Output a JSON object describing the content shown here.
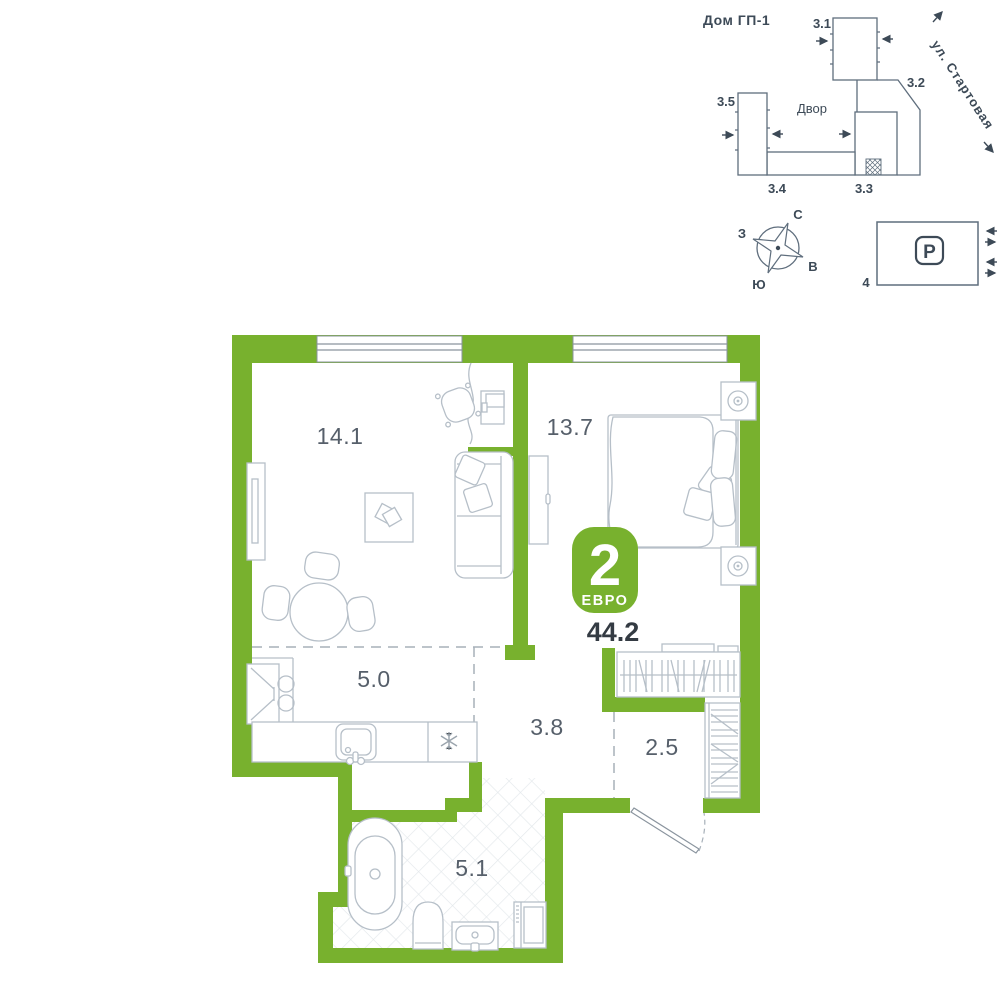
{
  "floor_plan": {
    "badge": {
      "rooms_number": "2",
      "type": "ЕВРО"
    },
    "total_area": "44.2",
    "areas": {
      "living_room": "14.1",
      "bedroom": "13.7",
      "kitchen": "5.0",
      "hallway": "3.8",
      "wardrobe": "2.5",
      "bathroom": "5.1"
    },
    "icons": {
      "fridge": "snowflake-icon",
      "bath": "bathtub-icon",
      "wc": "toilet-icon"
    }
  },
  "site_plan": {
    "title": "Дом ГП-1",
    "courtyard_label": "Двор",
    "street_label": "ул. Стартовая",
    "building_labels": {
      "b31": "3.1",
      "b32": "3.2",
      "b33": "3.3",
      "b34": "3.4",
      "b35": "3.5"
    }
  },
  "compass": {
    "north": "С",
    "east": "В",
    "south": "Ю",
    "west": "З"
  },
  "parking": {
    "symbol": "P",
    "number": "4"
  },
  "colors": {
    "wall_green": "#78b12e",
    "badge_green": "#78b12e",
    "site_outline": "#5f6e7d",
    "furniture_line": "#b6bfc8",
    "dark_text": "#3d4a57",
    "room_label": "#565f6a"
  }
}
